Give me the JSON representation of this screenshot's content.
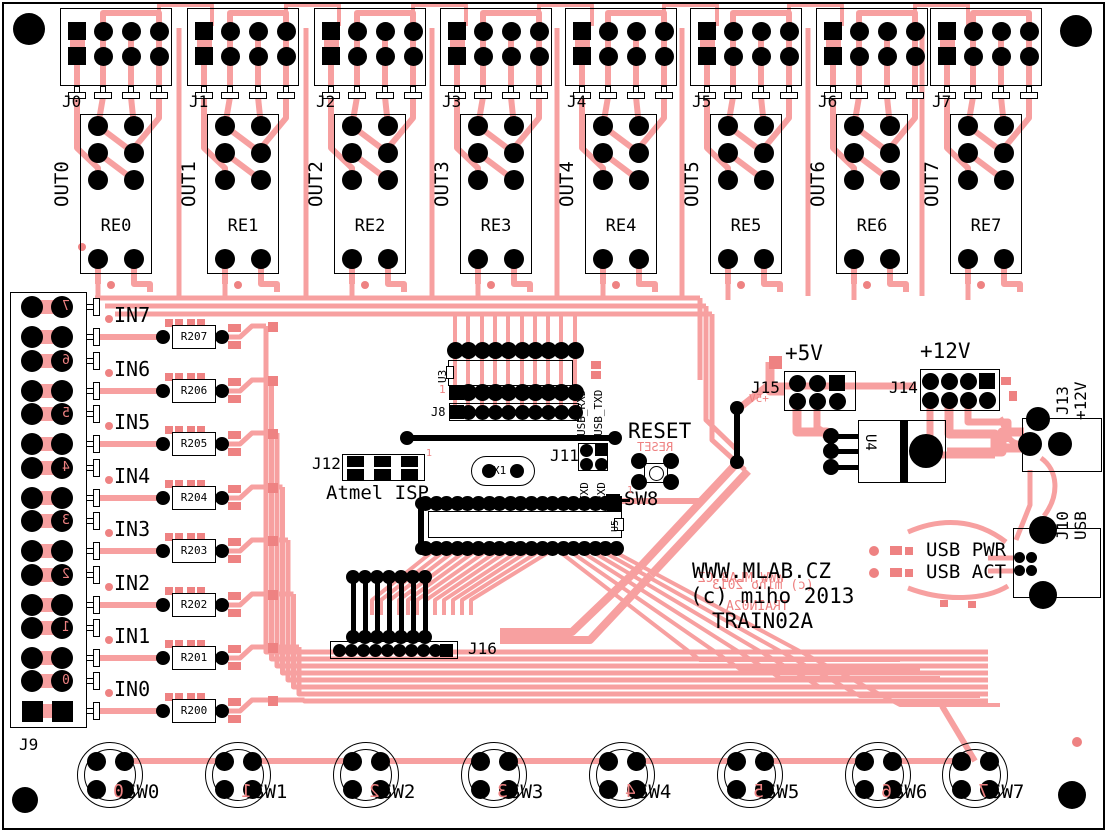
{
  "board": {
    "site": "WWW.MLAB.CZ",
    "copyright": "(c) miho 2013",
    "name": "TRAIN02A",
    "colors": {
      "copper": "#F7A0A0",
      "copper_red": "#EE8282",
      "silk": "#000000",
      "background": "#FFFFFF"
    }
  },
  "output_section": {
    "connectors": [
      {
        "connector": "J0",
        "relay": "RE0",
        "net": "OUT0"
      },
      {
        "connector": "J1",
        "relay": "RE1",
        "net": "OUT1"
      },
      {
        "connector": "J2",
        "relay": "RE2",
        "net": "OUT2"
      },
      {
        "connector": "J3",
        "relay": "RE3",
        "net": "OUT3"
      },
      {
        "connector": "J4",
        "relay": "RE4",
        "net": "OUT4"
      },
      {
        "connector": "J5",
        "relay": "RE5",
        "net": "OUT5"
      },
      {
        "connector": "J6",
        "relay": "RE6",
        "net": "OUT6"
      },
      {
        "connector": "J7",
        "relay": "RE7",
        "net": "OUT7"
      }
    ]
  },
  "input_section": {
    "connector": "J9",
    "rows": [
      {
        "net": "IN7",
        "resistor": "R207",
        "index_mark": "7"
      },
      {
        "net": "IN6",
        "resistor": "R206",
        "index_mark": "6"
      },
      {
        "net": "IN5",
        "resistor": "R205",
        "index_mark": "5"
      },
      {
        "net": "IN4",
        "resistor": "R204",
        "index_mark": "4"
      },
      {
        "net": "IN3",
        "resistor": "R203",
        "index_mark": "3"
      },
      {
        "net": "IN2",
        "resistor": "R202",
        "index_mark": "2"
      },
      {
        "net": "IN1",
        "resistor": "R201",
        "index_mark": "1"
      },
      {
        "net": "IN0",
        "resistor": "R200",
        "index_mark": "0"
      }
    ]
  },
  "switches": [
    {
      "label": "SW0",
      "index_mark": "0"
    },
    {
      "label": "SW1",
      "index_mark": "1"
    },
    {
      "label": "SW2",
      "index_mark": "2"
    },
    {
      "label": "SW3",
      "index_mark": "3"
    },
    {
      "label": "SW4",
      "index_mark": "4"
    },
    {
      "label": "SW5",
      "index_mark": "5"
    },
    {
      "label": "SW6",
      "index_mark": "6"
    },
    {
      "label": "SW7",
      "index_mark": "7"
    }
  ],
  "mcu": {
    "u3": "U3",
    "j8": "J8",
    "u5": "U5",
    "x1": "X1",
    "pin1": "1",
    "j11": {
      "label": "J11",
      "top_labels": [
        "USB_RXD",
        "USB_TXD"
      ],
      "bottom_labels": [
        "TXD",
        "RXD"
      ]
    },
    "j12": {
      "label": "J12",
      "caption": "Atmel ISP"
    },
    "reset_label": "RESET",
    "sw8": "SW8",
    "j16": "J16"
  },
  "power": {
    "j15": {
      "label": "J15",
      "net": "+5V"
    },
    "j14": {
      "label": "J14",
      "net": "+12V"
    },
    "j13": {
      "label": "J13",
      "net": "+12V"
    },
    "u4": "U4",
    "j10": {
      "label": "J10",
      "net": "USB"
    },
    "usb_pwr": "USB PWR",
    "usb_act": "USB ACT"
  }
}
